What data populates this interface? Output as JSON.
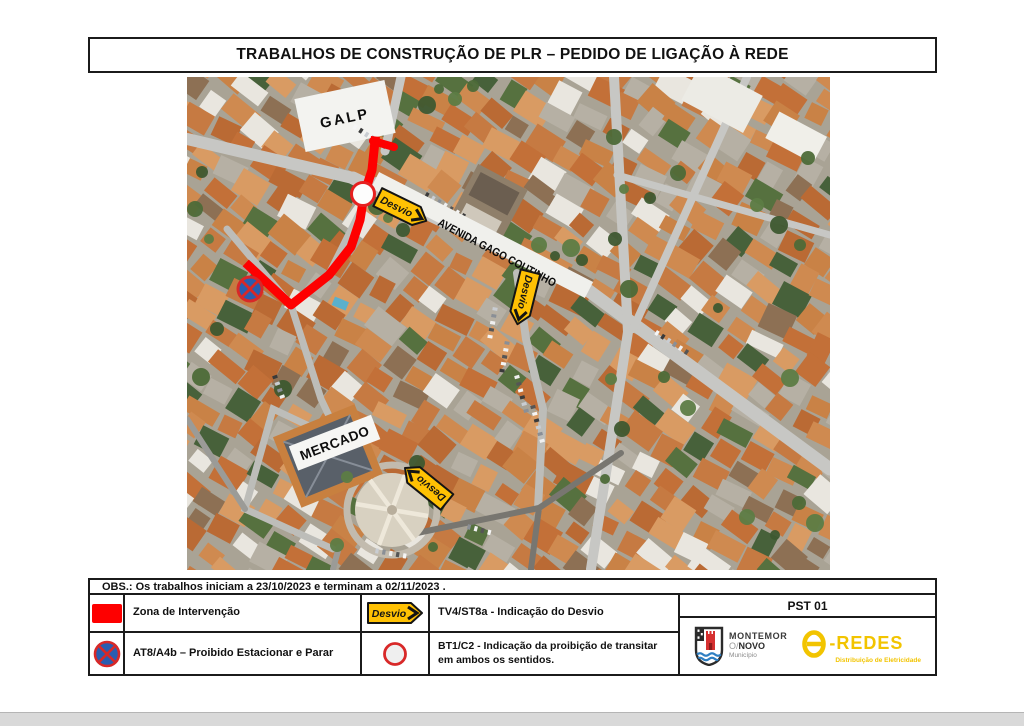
{
  "title": "TRABALHOS DE CONSTRUÇÃO DE PLR – PEDIDO DE LIGAÇÃO À REDE",
  "map": {
    "labels": {
      "galp": "GALP",
      "avenue": "AVENIDA GAGO COUTINHO",
      "mercado": "MERCADO",
      "desvio": "Desvio"
    },
    "colors": {
      "intervention_red": "#FE0000",
      "desvio_yellow": "#FFC103",
      "sign_blue": "#2A5DB0",
      "sign_ring_red": "#D82828"
    }
  },
  "obs_note": "OBS.: Os trabalhos iniciam a 23/10/2023 e terminam a 02/11/2023 .",
  "legend": {
    "row1": {
      "label1": "Zona de Intervenção",
      "label2": "TV4/ST8a - Indicação do Desvio"
    },
    "row2": {
      "label1": "AT8/A4b – Proibido Estacionar e Parar",
      "label2": "BT1/C2 - Indicação da proibição de transitar em ambos os sentidos."
    }
  },
  "title_block": {
    "code": "PST 01",
    "municipality": {
      "line1": "MONTEMOR",
      "line2_prefix": "O/",
      "line2": "NOVO",
      "line3": "Município"
    },
    "company": {
      "name": "-REDES",
      "tagline": "Distribuição de Eletricidade"
    }
  }
}
